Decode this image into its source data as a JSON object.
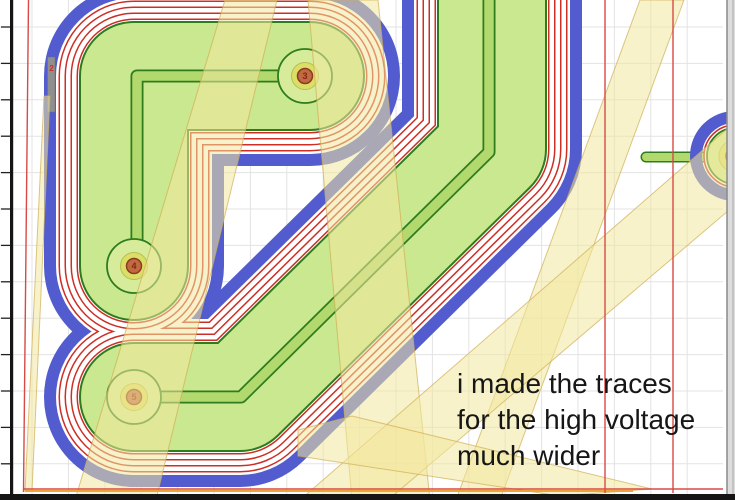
{
  "app": {
    "view_title": "pcb-cam-isolation-preview"
  },
  "annotation": {
    "line1": "i made the traces",
    "line2": "for the high voltage",
    "line3": "much wider"
  },
  "pad_labels": [
    "3",
    "4",
    "5"
  ],
  "marker_label": "2",
  "colors": {
    "background": "#ffffff",
    "grid": "#e3e3e3",
    "copper_fill": "#c9e88f",
    "copper_edge": "#2e7c1e",
    "trace_fill": "#b2d96e",
    "isolation_red": "#cc2f26",
    "outline_blue": "#525cce",
    "pad_fill": "#d6ec9a",
    "pad_ring": "#dbdf67",
    "drill_fill": "#c06a42",
    "drill_edge": "#8e3a22",
    "label_red": "#8a2413",
    "band_yellow": "#f2e79e",
    "band_edge": "#cfae54",
    "construct_red": "#d84a45",
    "outline_orange": "#eda43b",
    "ruler_black": "#151515",
    "panel_gray": "#dcdcdc",
    "marker_gray": "#8f8f8f",
    "white": "#ffffff"
  }
}
